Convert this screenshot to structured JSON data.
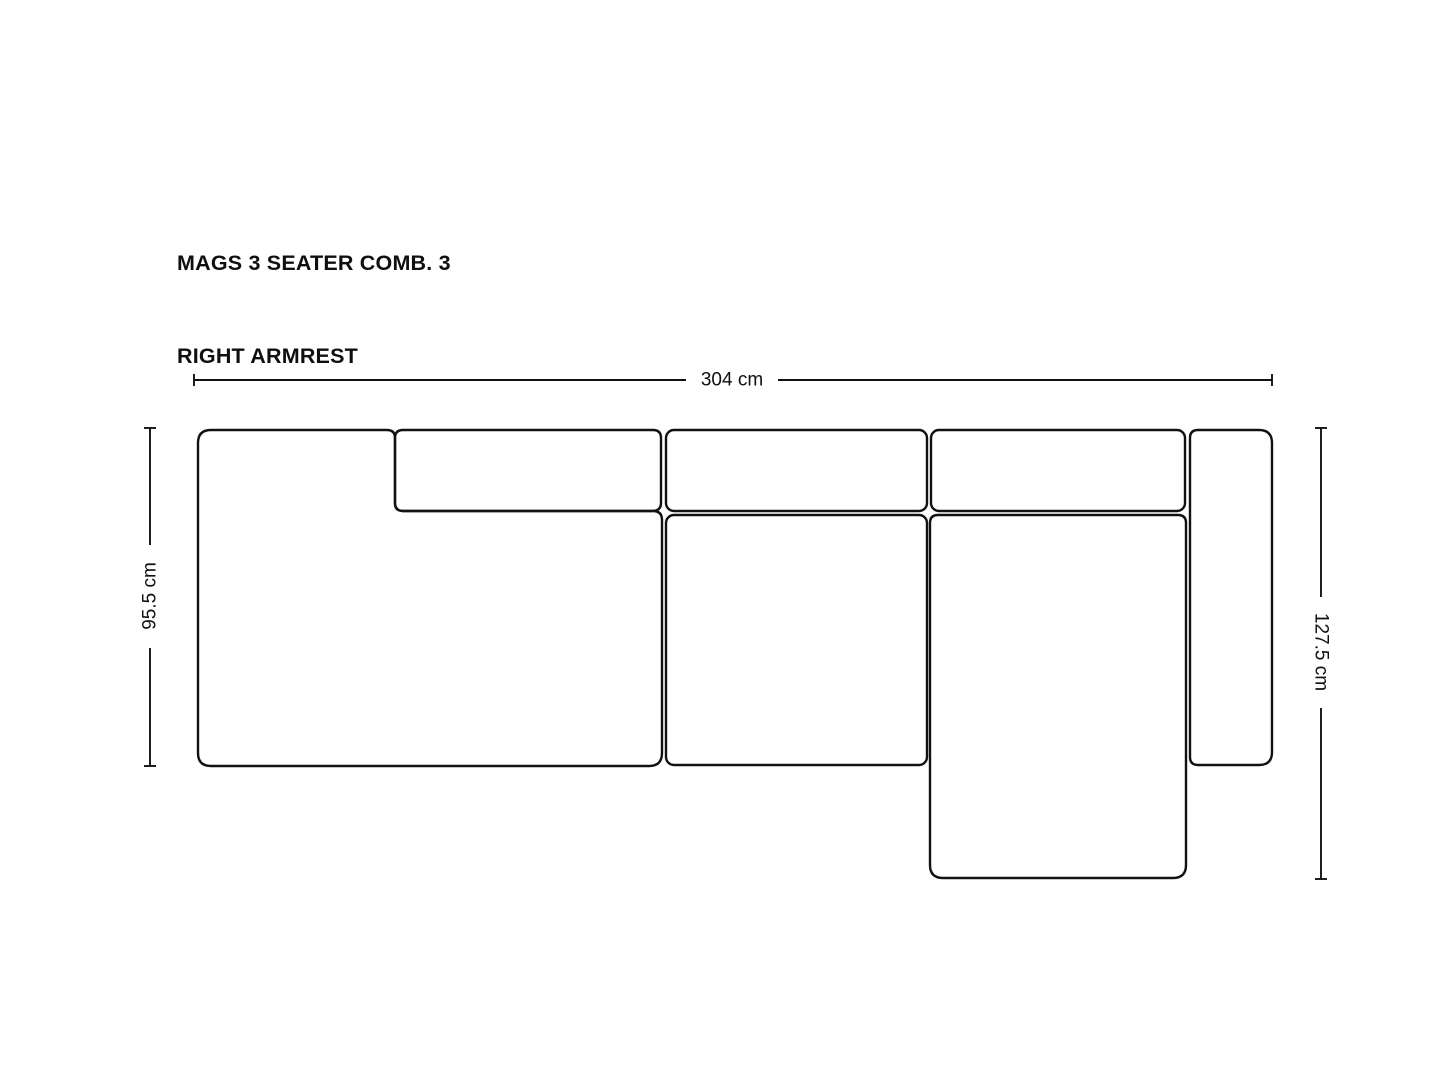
{
  "title": {
    "line1": "MAGS 3 SEATER COMB. 3",
    "line2": "RIGHT ARMREST"
  },
  "dimensions": {
    "overall_width": {
      "label": "304 cm"
    },
    "left_depth": {
      "label": "95.5 cm"
    },
    "right_depth": {
      "label": "127.5 cm"
    }
  },
  "colors": {
    "line": "#121212",
    "text": "#0f0f0f",
    "background": "#ffffff"
  }
}
